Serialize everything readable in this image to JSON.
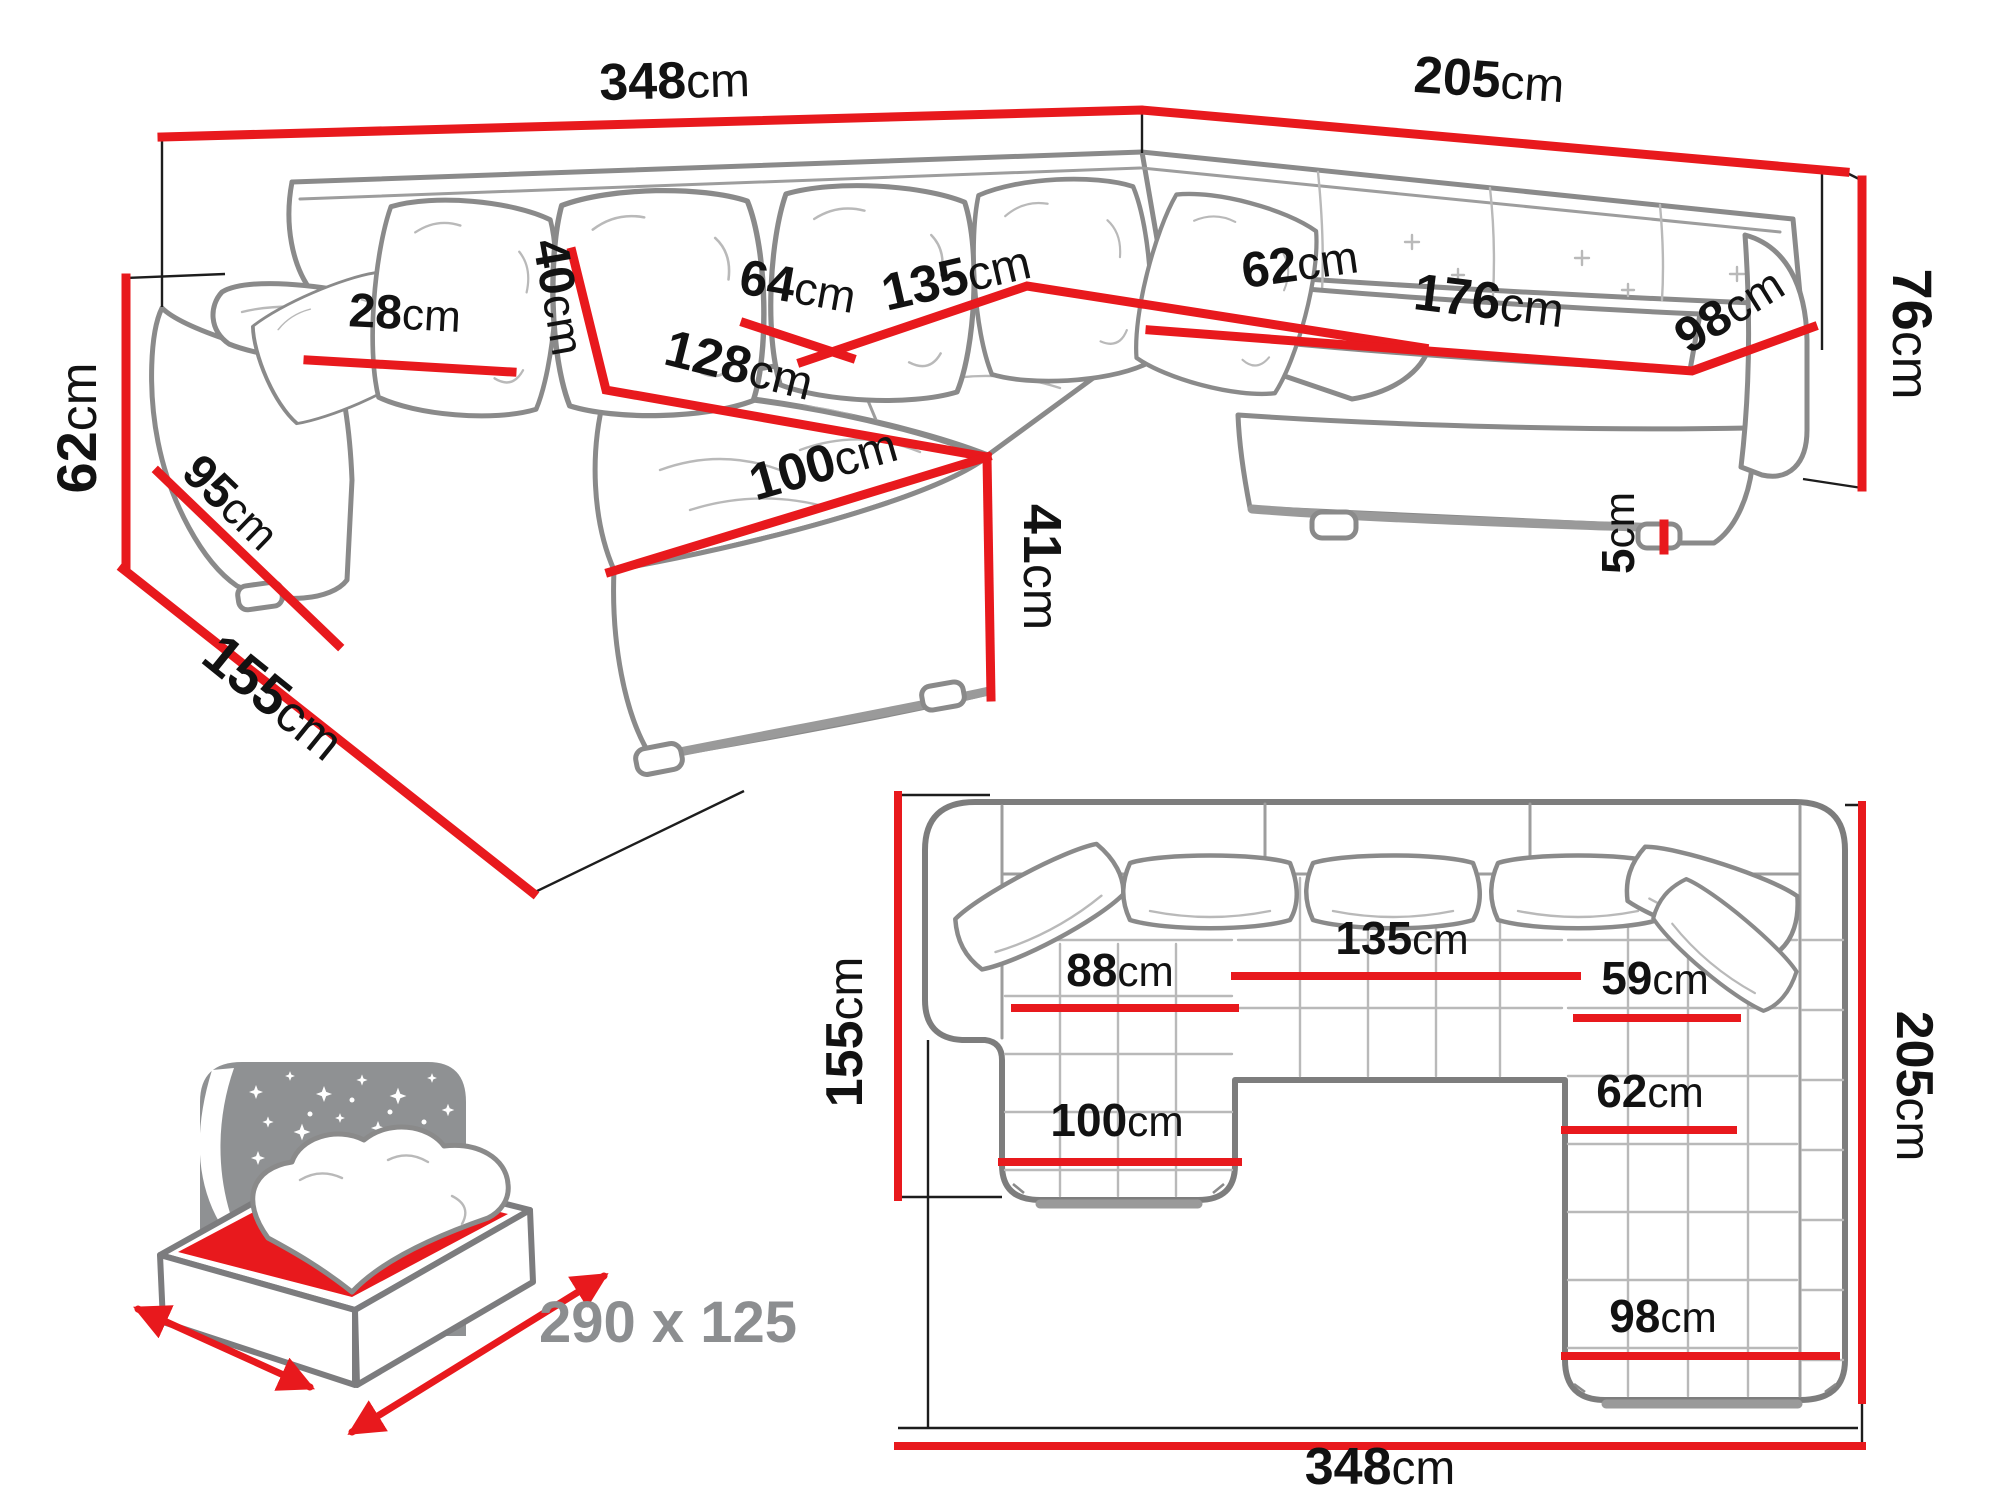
{
  "diagram_type": "corner-sofa dimension drawing",
  "unit": "cm",
  "colors": {
    "dimension_red": "#e8191d",
    "outline_gray": "#8a8a8a",
    "label_black": "#121212",
    "caption_gray": "#8c8e90"
  },
  "labels": {
    "p348": {
      "n": "348",
      "u": "cm"
    },
    "p205": {
      "n": "205",
      "u": "cm"
    },
    "p62": {
      "n": "62",
      "u": "cm"
    },
    "p155": {
      "n": "155",
      "u": "cm"
    },
    "p95": {
      "n": "95",
      "u": "cm"
    },
    "p28": {
      "n": "28",
      "u": "cm"
    },
    "p40": {
      "n": "40",
      "u": "cm"
    },
    "p64": {
      "n": "64",
      "u": "cm"
    },
    "p135": {
      "n": "135",
      "u": "cm"
    },
    "p62c": {
      "n": "62",
      "u": "cm"
    },
    "p176": {
      "n": "176",
      "u": "cm"
    },
    "p98": {
      "n": "98",
      "u": "cm"
    },
    "p76": {
      "n": "76",
      "u": "cm"
    },
    "p5": {
      "n": "5",
      "u": "cm"
    },
    "p128": {
      "n": "128",
      "u": "cm"
    },
    "p100": {
      "n": "100",
      "u": "cm"
    },
    "p41": {
      "n": "41",
      "u": "cm"
    },
    "t155": {
      "n": "155",
      "u": "cm"
    },
    "t205": {
      "n": "205",
      "u": "cm"
    },
    "t348": {
      "n": "348",
      "u": "cm"
    },
    "t88": {
      "n": "88",
      "u": "cm"
    },
    "t135": {
      "n": "135",
      "u": "cm"
    },
    "t59": {
      "n": "59",
      "u": "cm"
    },
    "t62": {
      "n": "62",
      "u": "cm"
    },
    "t100": {
      "n": "100",
      "u": "cm"
    },
    "t98": {
      "n": "98",
      "u": "cm"
    }
  },
  "sleeping_area": {
    "size": "290 x 125"
  }
}
